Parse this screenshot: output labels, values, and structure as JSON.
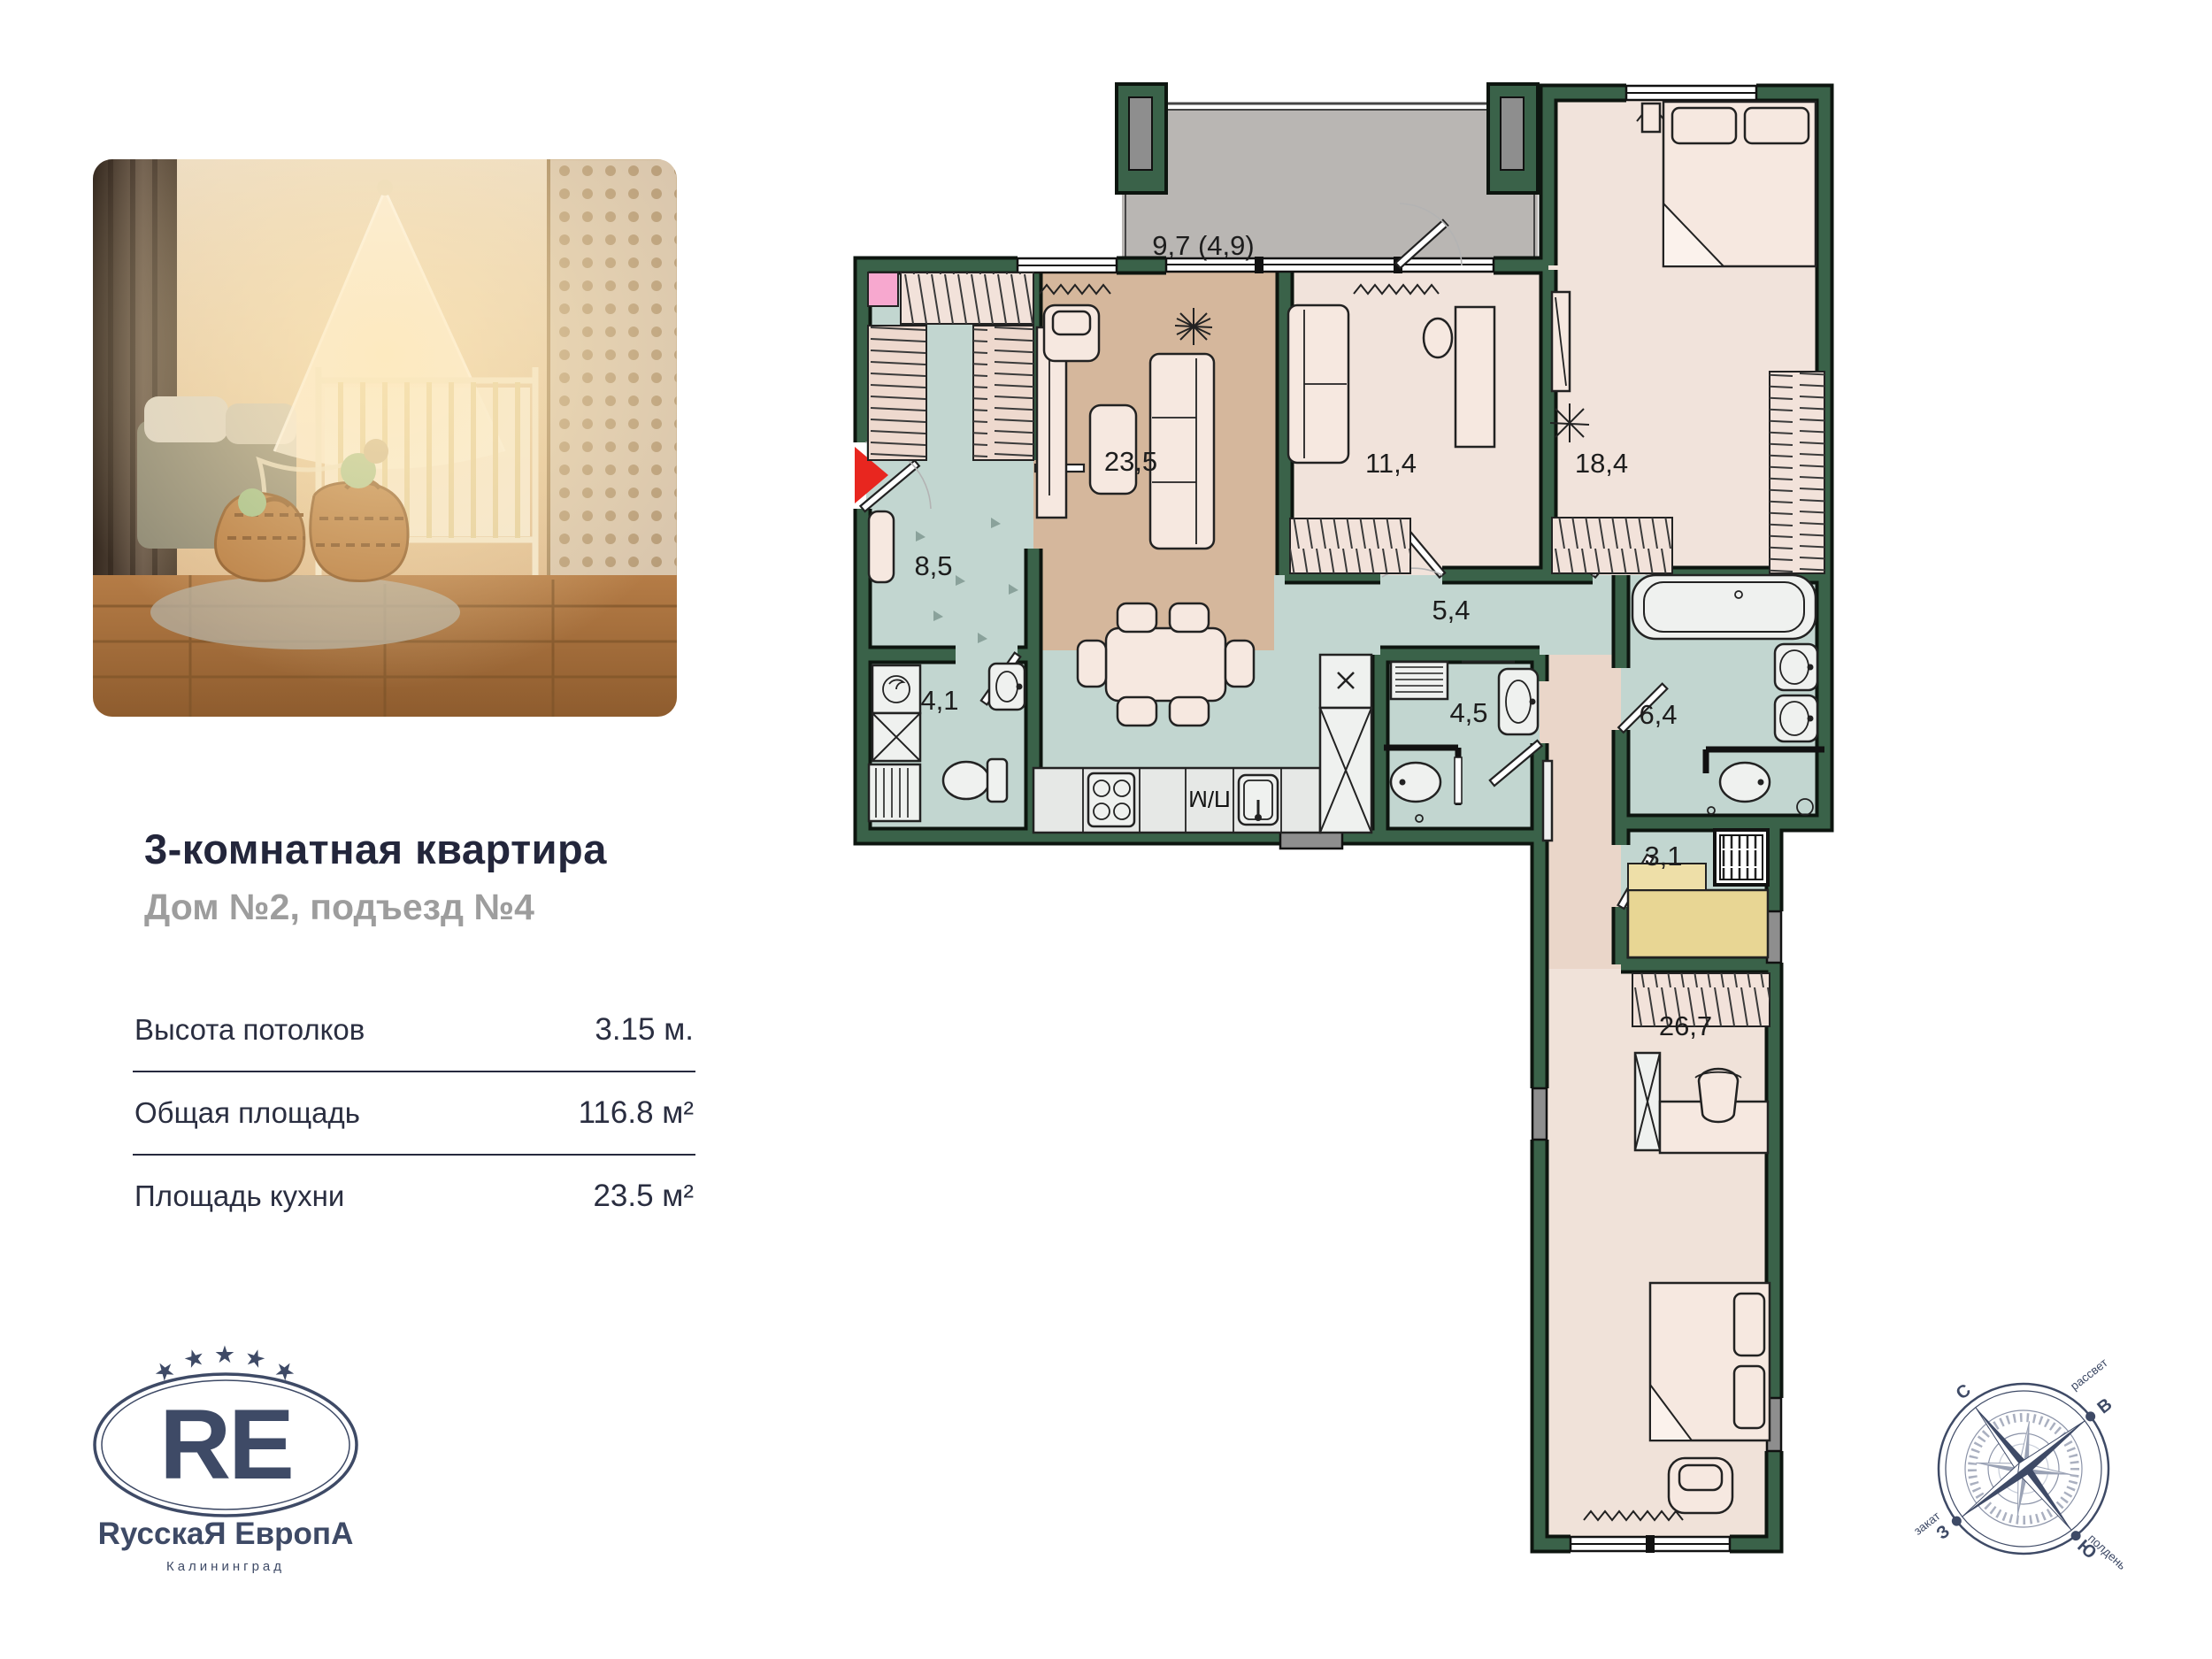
{
  "listing": {
    "title": "3-комнатная квартира",
    "subtitle": "Дом №2, подъезд №4",
    "specs": [
      {
        "label": "Высота потолков",
        "value": "3.15 м."
      },
      {
        "label": "Общая площадь",
        "value": "116.8 м²"
      },
      {
        "label": "Площадь кухни",
        "value": "23.5 м²"
      }
    ]
  },
  "logo": {
    "monogram": "RE",
    "name": "RусскаЯ ЕвропА",
    "city": "Калининград",
    "star": "★",
    "color": "#3e4a66"
  },
  "plan": {
    "rooms": [
      {
        "id": "balcony",
        "area": "9,7 (4,9)"
      },
      {
        "id": "kitchen-living",
        "area": "23,5"
      },
      {
        "id": "bedroom-2",
        "area": "11,4"
      },
      {
        "id": "bedroom-1",
        "area": "18,4"
      },
      {
        "id": "entry-hall",
        "area": "8,5"
      },
      {
        "id": "corridor",
        "area": "5,4"
      },
      {
        "id": "wc",
        "area": "4,1"
      },
      {
        "id": "bathroom",
        "area": "4,5"
      },
      {
        "id": "shower-room",
        "area": "6,4"
      },
      {
        "id": "sauna",
        "area": "3,1"
      },
      {
        "id": "bedroom-3",
        "area": "26,7"
      }
    ],
    "appliance_label": "П/М",
    "colors": {
      "wall_green": "#3a6249",
      "wall_outline": "#0d150f",
      "floor_tan": "#d5b79c",
      "floor_light": "#f1e3db",
      "floor_wet_teal": "#c2d6d0",
      "floor_corridor": "#ead6c9",
      "balcony_gray": "#b9b6b3",
      "sauna_bench_yellow": "#e8d694",
      "entry_arrow_red": "#e8261f"
    }
  },
  "compass": {
    "north": "С",
    "east": "В",
    "south": "Ю",
    "west": "З",
    "sunrise": "рассвет",
    "sunset": "закат",
    "noon": "полдень"
  }
}
